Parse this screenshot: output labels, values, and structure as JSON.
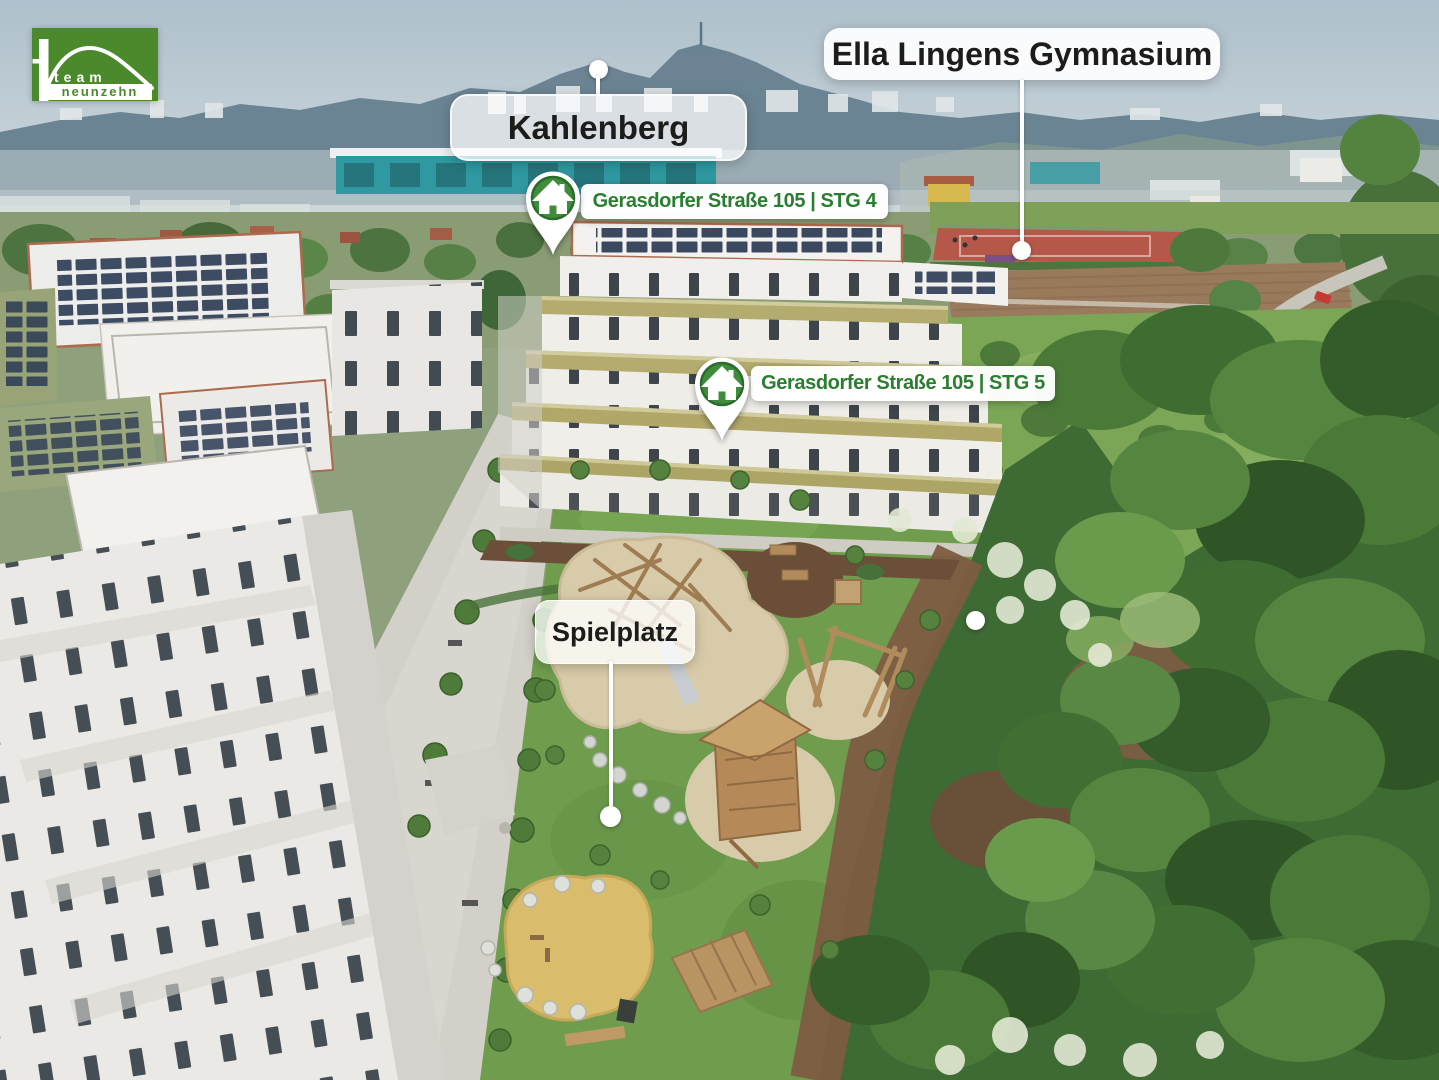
{
  "brand": {
    "logo_text_top": "team",
    "logo_text_bottom": "neunzehn"
  },
  "callouts": {
    "kahlenberg": {
      "label": "Kahlenberg"
    },
    "ella_lingens_gymnasium": {
      "label": "Ella Lingens Gymnasium"
    },
    "spielplatz": {
      "label": "Spielplatz"
    },
    "gerasdorfer_stg4": {
      "label": "Gerasdorfer Straße 105 | STG 4"
    },
    "gerasdorfer_stg5": {
      "label": "Gerasdorfer Straße 105 | STG 5"
    }
  },
  "colors": {
    "brand_green": "#4a8a2c",
    "label_green": "#2b7e31",
    "pin_green": "#3f8c3c",
    "label_text_dark": "#1c1c1a"
  }
}
